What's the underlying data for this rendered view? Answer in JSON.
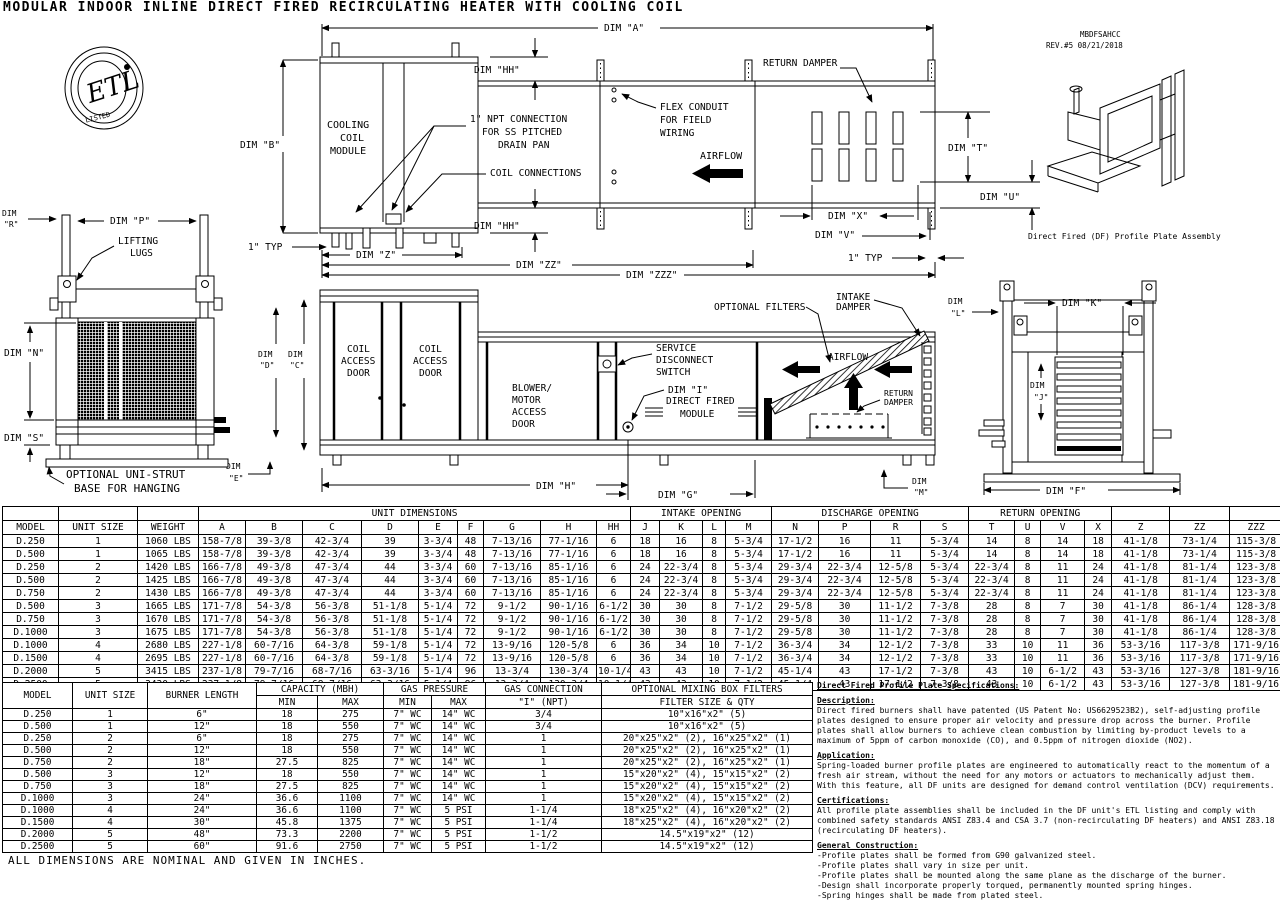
{
  "title": "MODULAR INDOOR INLINE DIRECT FIRED RECIRCULATING HEATER WITH COOLING COIL",
  "header": {
    "code": "MBDFSAHCC",
    "revision": "REV.#5 08/21/2018"
  },
  "logo": {
    "etl": "ETL",
    "listed": "LISTED"
  },
  "drawing": {
    "plan": {
      "dim_a": "DIM \"A\"",
      "dim_b": "DIM \"B\"",
      "dim_hh": "DIM \"HH\"",
      "cooling_coil": [
        "COOLING",
        "COIL",
        "MODULE"
      ],
      "npt": [
        "1\" NPT CONNECTION",
        "FOR SS PITCHED",
        "DRAIN PAN"
      ],
      "coil_connections": "COIL CONNECTIONS",
      "flex": [
        "FLEX CONDUIT",
        "FOR FIELD",
        "WIRING"
      ],
      "airflow": "AIRFLOW",
      "return_damper": "RETURN DAMPER",
      "dim_t": "DIM \"T\"",
      "dim_u": "DIM \"U\"",
      "dim_x": "DIM \"X\"",
      "dim_v": "DIM \"V\"",
      "one_typ": "1\" TYP",
      "dim_z": "DIM \"Z\"",
      "dim_zz": "DIM \"ZZ\"",
      "dim_zzz": "DIM \"ZZZ\""
    },
    "side": {
      "coil_access": [
        "COIL",
        "ACCESS",
        "DOOR"
      ],
      "blower": [
        "BLOWER/",
        "MOTOR",
        "ACCESS",
        "DOOR"
      ],
      "service": [
        "SERVICE",
        "DISCONNECT",
        "SWITCH"
      ],
      "dim_i": "DIM \"I\"",
      "direct_fired": [
        "DIRECT FIRED",
        "MODULE"
      ],
      "optional_filters": "OPTIONAL FILTERS",
      "intake_damper": [
        "INTAKE",
        "DAMPER"
      ],
      "return_damper": [
        "RETURN",
        "DAMPER"
      ],
      "airflow": "AIRFLOW",
      "dim_c": [
        "DIM",
        "\"C\""
      ],
      "dim_d": [
        "DIM",
        "\"D\""
      ],
      "dim_h": "DIM \"H\"",
      "dim_g": "DIM \"G\"",
      "dim_l": [
        "DIM",
        "\"L\""
      ],
      "dim_m": [
        "DIM",
        "\"M\""
      ],
      "dim_e": [
        "DIM",
        "\"E\""
      ]
    },
    "left_view": {
      "dim_r": [
        "DIM",
        "\"R\""
      ],
      "dim_p": "DIM \"P\"",
      "lifting": [
        "LIFTING",
        "LUGS"
      ],
      "dim_n": "DIM \"N\"",
      "dim_s": "DIM \"S\"",
      "unistrut": [
        "OPTIONAL UNI-STRUT",
        "BASE FOR HANGING"
      ]
    },
    "right_view": {
      "dim_k": "DIM \"K\"",
      "dim_j": [
        "DIM",
        "\"J\""
      ],
      "dim_f": "DIM \"F\""
    },
    "iso_caption": "Direct Fired (DF) Profile Plate Assembly"
  },
  "dim_table": {
    "groups": [
      {
        "label": "",
        "span": 1
      },
      {
        "label": "",
        "span": 1
      },
      {
        "label": "",
        "span": 1
      },
      {
        "label": "UNIT DIMENSIONS",
        "span": 9
      },
      {
        "label": "INTAKE OPENING",
        "span": 4
      },
      {
        "label": "DISCHARGE OPENING",
        "span": 4
      },
      {
        "label": "RETURN OPENING",
        "span": 4
      },
      {
        "label": "",
        "span": 1
      },
      {
        "label": "",
        "span": 1
      },
      {
        "label": "",
        "span": 1
      }
    ],
    "columns": [
      "MODEL",
      "UNIT SIZE",
      "WEIGHT",
      "A",
      "B",
      "C",
      "D",
      "E",
      "F",
      "G",
      "H",
      "HH",
      "J",
      "K",
      "L",
      "M",
      "N",
      "P",
      "R",
      "S",
      "T",
      "U",
      "V",
      "X",
      "Z",
      "ZZ",
      "ZZZ"
    ],
    "rows": [
      [
        "D.250",
        "1",
        "1060 LBS",
        "158-7/8",
        "39-3/8",
        "42-3/4",
        "39",
        "3-3/4",
        "48",
        "7-13/16",
        "77-1/16",
        "6",
        "18",
        "16",
        "8",
        "5-3/4",
        "17-1/2",
        "16",
        "11",
        "5-3/4",
        "14",
        "8",
        "14",
        "18",
        "41-1/8",
        "73-1/4",
        "115-3/8"
      ],
      [
        "D.500",
        "1",
        "1065 LBS",
        "158-7/8",
        "39-3/8",
        "42-3/4",
        "39",
        "3-3/4",
        "48",
        "7-13/16",
        "77-1/16",
        "6",
        "18",
        "16",
        "8",
        "5-3/4",
        "17-1/2",
        "16",
        "11",
        "5-3/4",
        "14",
        "8",
        "14",
        "18",
        "41-1/8",
        "73-1/4",
        "115-3/8"
      ],
      [
        "D.250",
        "2",
        "1420 LBS",
        "166-7/8",
        "49-3/8",
        "47-3/4",
        "44",
        "3-3/4",
        "60",
        "7-13/16",
        "85-1/16",
        "6",
        "24",
        "22-3/4",
        "8",
        "5-3/4",
        "29-3/4",
        "22-3/4",
        "12-5/8",
        "5-3/4",
        "22-3/4",
        "8",
        "11",
        "24",
        "41-1/8",
        "81-1/4",
        "123-3/8"
      ],
      [
        "D.500",
        "2",
        "1425 LBS",
        "166-7/8",
        "49-3/8",
        "47-3/4",
        "44",
        "3-3/4",
        "60",
        "7-13/16",
        "85-1/16",
        "6",
        "24",
        "22-3/4",
        "8",
        "5-3/4",
        "29-3/4",
        "22-3/4",
        "12-5/8",
        "5-3/4",
        "22-3/4",
        "8",
        "11",
        "24",
        "41-1/8",
        "81-1/4",
        "123-3/8"
      ],
      [
        "D.750",
        "2",
        "1430 LBS",
        "166-7/8",
        "49-3/8",
        "47-3/4",
        "44",
        "3-3/4",
        "60",
        "7-13/16",
        "85-1/16",
        "6",
        "24",
        "22-3/4",
        "8",
        "5-3/4",
        "29-3/4",
        "22-3/4",
        "12-5/8",
        "5-3/4",
        "22-3/4",
        "8",
        "11",
        "24",
        "41-1/8",
        "81-1/4",
        "123-3/8"
      ],
      [
        "D.500",
        "3",
        "1665 LBS",
        "171-7/8",
        "54-3/8",
        "56-3/8",
        "51-1/8",
        "5-1/4",
        "72",
        "9-1/2",
        "90-1/16",
        "6-1/2",
        "30",
        "30",
        "8",
        "7-1/2",
        "29-5/8",
        "30",
        "11-1/2",
        "7-3/8",
        "28",
        "8",
        "7",
        "30",
        "41-1/8",
        "86-1/4",
        "128-3/8"
      ],
      [
        "D.750",
        "3",
        "1670 LBS",
        "171-7/8",
        "54-3/8",
        "56-3/8",
        "51-1/8",
        "5-1/4",
        "72",
        "9-1/2",
        "90-1/16",
        "6-1/2",
        "30",
        "30",
        "8",
        "7-1/2",
        "29-5/8",
        "30",
        "11-1/2",
        "7-3/8",
        "28",
        "8",
        "7",
        "30",
        "41-1/8",
        "86-1/4",
        "128-3/8"
      ],
      [
        "D.1000",
        "3",
        "1675 LBS",
        "171-7/8",
        "54-3/8",
        "56-3/8",
        "51-1/8",
        "5-1/4",
        "72",
        "9-1/2",
        "90-1/16",
        "6-1/2",
        "30",
        "30",
        "8",
        "7-1/2",
        "29-5/8",
        "30",
        "11-1/2",
        "7-3/8",
        "28",
        "8",
        "7",
        "30",
        "41-1/8",
        "86-1/4",
        "128-3/8"
      ],
      [
        "D.1000",
        "4",
        "2680 LBS",
        "227-1/8",
        "60-7/16",
        "64-3/8",
        "59-1/8",
        "5-1/4",
        "72",
        "13-9/16",
        "120-5/8",
        "6",
        "36",
        "34",
        "10",
        "7-1/2",
        "36-3/4",
        "34",
        "12-1/2",
        "7-3/8",
        "33",
        "10",
        "11",
        "36",
        "53-3/16",
        "117-3/8",
        "171-9/16"
      ],
      [
        "D.1500",
        "4",
        "2695 LBS",
        "227-1/8",
        "60-7/16",
        "64-3/8",
        "59-1/8",
        "5-1/4",
        "72",
        "13-9/16",
        "120-5/8",
        "6",
        "36",
        "34",
        "10",
        "7-1/2",
        "36-3/4",
        "34",
        "12-1/2",
        "7-3/8",
        "33",
        "10",
        "11",
        "36",
        "53-3/16",
        "117-3/8",
        "171-9/16"
      ],
      [
        "D.2000",
        "5",
        "3415 LBS",
        "237-1/8",
        "79-7/16",
        "68-7/16",
        "63-3/16",
        "5-1/4",
        "96",
        "13-3/4",
        "130-3/4",
        "10-1/4",
        "43",
        "43",
        "10",
        "7-1/2",
        "45-1/4",
        "43",
        "17-1/2",
        "7-3/8",
        "43",
        "10",
        "6-1/2",
        "43",
        "53-3/16",
        "127-3/8",
        "181-9/16"
      ],
      [
        "D.2500",
        "5",
        "3430 LBS",
        "237-1/8",
        "79-7/16",
        "68-7/16",
        "63-3/16",
        "5-1/4",
        "96",
        "13-3/4",
        "130-3/4",
        "10-1/4",
        "43",
        "43",
        "10",
        "7-1/2",
        "45-1/4",
        "43",
        "17-1/2",
        "7-3/8",
        "43",
        "10",
        "6-1/2",
        "43",
        "53-3/16",
        "127-3/8",
        "181-9/16"
      ]
    ]
  },
  "cap_table": {
    "row1": [
      {
        "label": "MODEL",
        "rowspan": 2
      },
      {
        "label": "UNIT SIZE",
        "rowspan": 2
      },
      {
        "label": "BURNER LENGTH",
        "rowspan": 2
      },
      {
        "label": "CAPACITY (MBH)",
        "colspan": 2
      },
      {
        "label": "GAS PRESSURE",
        "colspan": 2
      },
      {
        "label": "GAS CONNECTION"
      },
      {
        "label": "OPTIONAL MIXING BOX FILTERS"
      }
    ],
    "row2": [
      "MIN",
      "MAX",
      "MIN",
      "MAX",
      "\"I\" (NPT)",
      "FILTER SIZE & QTY"
    ],
    "rows": [
      [
        "D.250",
        "1",
        "6\"",
        "18",
        "275",
        "7\" WC",
        "14\" WC",
        "3/4",
        "10\"x16\"x2\" (5)"
      ],
      [
        "D.500",
        "1",
        "12\"",
        "18",
        "550",
        "7\" WC",
        "14\" WC",
        "3/4",
        "10\"x16\"x2\" (5)"
      ],
      [
        "D.250",
        "2",
        "6\"",
        "18",
        "275",
        "7\" WC",
        "14\" WC",
        "1",
        "20\"x25\"x2\" (2), 16\"x25\"x2\" (1)"
      ],
      [
        "D.500",
        "2",
        "12\"",
        "18",
        "550",
        "7\" WC",
        "14\" WC",
        "1",
        "20\"x25\"x2\" (2), 16\"x25\"x2\" (1)"
      ],
      [
        "D.750",
        "2",
        "18\"",
        "27.5",
        "825",
        "7\" WC",
        "14\" WC",
        "1",
        "20\"x25\"x2\" (2), 16\"x25\"x2\" (1)"
      ],
      [
        "D.500",
        "3",
        "12\"",
        "18",
        "550",
        "7\" WC",
        "14\" WC",
        "1",
        "15\"x20\"x2\" (4), 15\"x15\"x2\" (2)"
      ],
      [
        "D.750",
        "3",
        "18\"",
        "27.5",
        "825",
        "7\" WC",
        "14\" WC",
        "1",
        "15\"x20\"x2\" (4), 15\"x15\"x2\" (2)"
      ],
      [
        "D.1000",
        "3",
        "24\"",
        "36.6",
        "1100",
        "7\" WC",
        "14\" WC",
        "1",
        "15\"x20\"x2\" (4), 15\"x15\"x2\" (2)"
      ],
      [
        "D.1000",
        "4",
        "24\"",
        "36.6",
        "1100",
        "7\" WC",
        "5 PSI",
        "1-1/4",
        "18\"x25\"x2\" (4), 16\"x20\"x2\" (2)"
      ],
      [
        "D.1500",
        "4",
        "30\"",
        "45.8",
        "1375",
        "7\" WC",
        "5 PSI",
        "1-1/4",
        "18\"x25\"x2\" (4), 16\"x20\"x2\" (2)"
      ],
      [
        "D.2000",
        "5",
        "48\"",
        "73.3",
        "2200",
        "7\" WC",
        "5 PSI",
        "1-1/2",
        "14.5\"x19\"x2\" (12)"
      ],
      [
        "D.2500",
        "5",
        "60\"",
        "91.6",
        "2750",
        "7\" WC",
        "5 PSI",
        "1-1/2",
        "14.5\"x19\"x2\" (12)"
      ]
    ]
  },
  "specs": {
    "title": "Direct Fired Profile Plate Specifications:",
    "sections": [
      {
        "heading": "Description:",
        "body": "Direct fired burners shall have patented (US Patent No: US6629523B2), self-adjusting profile plates designed to ensure proper air velocity and pressure drop across the burner. Profile plates shall allow burners to achieve clean combustion by limiting by-product levels to a maximum of 5ppm of carbon monoxide (CO), and 0.5ppm of nitrogen dioxide (NO2).",
        "bullets": []
      },
      {
        "heading": "Application:",
        "body": "Spring-loaded burner profile plates are engineered to automatically react to the momentum of a fresh air stream, without the need for any motors or actuators to mechanically adjust them. With this feature, all DF units are designed for demand control ventilation (DCV) requirements.",
        "bullets": []
      },
      {
        "heading": "Certifications:",
        "body": "All profile plate assemblies shall be included in the DF unit's ETL listing and comply with combined safety standards ANSI Z83.4 and CSA 3.7 (non-recirculating DF heaters) and ANSI Z83.18 (recirculating DF heaters).",
        "bullets": []
      },
      {
        "heading": "General Construction:",
        "body": "",
        "bullets": [
          "-Profile plates shall be formed from G90 galvanized steel.",
          "-Profile plates shall vary in size per unit.",
          "-Profile plates shall be mounted along the same plane as the discharge of the burner.",
          "-Design shall incorporate properly torqued, permanently mounted spring hinges.",
          "-Spring hinges shall be made from plated steel."
        ]
      }
    ]
  },
  "footnote": "ALL DIMENSIONS ARE NOMINAL AND GIVEN IN INCHES."
}
